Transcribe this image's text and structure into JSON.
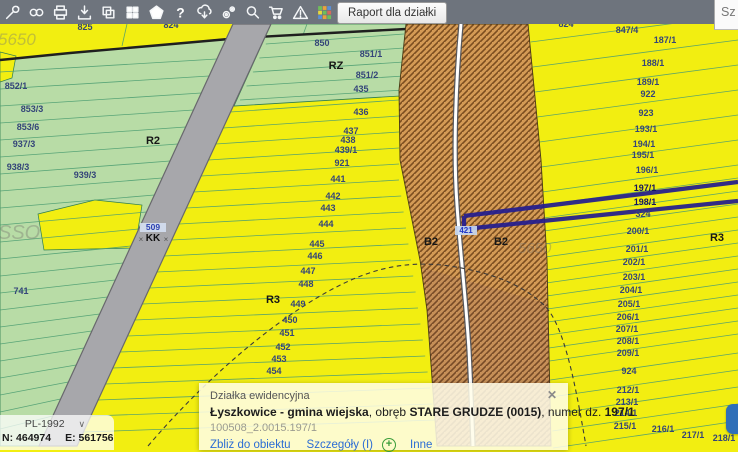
{
  "toolbar": {
    "background": "#6e747d",
    "icons": [
      {
        "name": "tools-icon"
      },
      {
        "name": "link-icon"
      },
      {
        "name": "print-icon"
      },
      {
        "name": "download-icon"
      },
      {
        "name": "copy-icon"
      },
      {
        "name": "tiles-icon"
      },
      {
        "name": "polygon-icon"
      },
      {
        "name": "help-icon"
      },
      {
        "name": "cloud-download-icon"
      },
      {
        "name": "settings-icon"
      },
      {
        "name": "search-icon"
      },
      {
        "name": "cart-icon"
      },
      {
        "name": "warning-icon"
      },
      {
        "name": "palette-icon"
      }
    ],
    "report_button_label": "Raport dla działki",
    "side_panel_label": "Sz"
  },
  "map": {
    "colors": {
      "parcel_yellow": "#f2ee11",
      "parcel_green": "#b8dca6",
      "railway_gray": "#a7a7ab",
      "hatch_orange": "#d49a55",
      "hatch_line": "#7c4e20",
      "selection_blue": "#241d8e",
      "boundary_green": "#4d9e72",
      "label_navy": "#344579"
    },
    "labels": [
      {
        "t": "825",
        "x": 85,
        "y": 30,
        "c": "p"
      },
      {
        "t": "824",
        "x": 171,
        "y": 28,
        "c": "p"
      },
      {
        "t": "824",
        "x": 566,
        "y": 27,
        "c": "p"
      },
      {
        "t": "850",
        "x": 322,
        "y": 46,
        "c": "p"
      },
      {
        "t": "851/1",
        "x": 371,
        "y": 57,
        "c": "p"
      },
      {
        "t": "RZ",
        "x": 336,
        "y": 69,
        "c": "k"
      },
      {
        "t": "851/2",
        "x": 367,
        "y": 78,
        "c": "p"
      },
      {
        "t": "435",
        "x": 361,
        "y": 92,
        "c": "p"
      },
      {
        "t": "436",
        "x": 361,
        "y": 115,
        "c": "p"
      },
      {
        "t": "437",
        "x": 351,
        "y": 134,
        "c": "p"
      },
      {
        "t": "438",
        "x": 348,
        "y": 143,
        "c": "p"
      },
      {
        "t": "439/1",
        "x": 346,
        "y": 153,
        "c": "p"
      },
      {
        "t": "921",
        "x": 342,
        "y": 166,
        "c": "p"
      },
      {
        "t": "441",
        "x": 338,
        "y": 182,
        "c": "p"
      },
      {
        "t": "442",
        "x": 333,
        "y": 199,
        "c": "p"
      },
      {
        "t": "443",
        "x": 328,
        "y": 211,
        "c": "p"
      },
      {
        "t": "444",
        "x": 326,
        "y": 227,
        "c": "p"
      },
      {
        "t": "445",
        "x": 317,
        "y": 247,
        "c": "p"
      },
      {
        "t": "446",
        "x": 315,
        "y": 259,
        "c": "p"
      },
      {
        "t": "447",
        "x": 308,
        "y": 274,
        "c": "p"
      },
      {
        "t": "448",
        "x": 306,
        "y": 287,
        "c": "p"
      },
      {
        "t": "R3",
        "x": 273,
        "y": 303,
        "c": "k"
      },
      {
        "t": "449",
        "x": 298,
        "y": 307,
        "c": "p"
      },
      {
        "t": "450",
        "x": 290,
        "y": 323,
        "c": "p"
      },
      {
        "t": "451",
        "x": 287,
        "y": 336,
        "c": "p"
      },
      {
        "t": "452",
        "x": 283,
        "y": 350,
        "c": "p"
      },
      {
        "t": "453",
        "x": 279,
        "y": 362,
        "c": "p"
      },
      {
        "t": "454",
        "x": 274,
        "y": 374,
        "c": "p"
      },
      {
        "t": "852/1",
        "x": 16,
        "y": 89,
        "c": "p"
      },
      {
        "t": "853/3",
        "x": 32,
        "y": 112,
        "c": "p"
      },
      {
        "t": "853/6",
        "x": 28,
        "y": 130,
        "c": "p"
      },
      {
        "t": "937/3",
        "x": 24,
        "y": 147,
        "c": "p"
      },
      {
        "t": "938/3",
        "x": 18,
        "y": 170,
        "c": "p"
      },
      {
        "t": "939/3",
        "x": 85,
        "y": 178,
        "c": "p"
      },
      {
        "t": "R2",
        "x": 153,
        "y": 144,
        "c": "k"
      },
      {
        "t": "741",
        "x": 21,
        "y": 294,
        "c": "p"
      },
      {
        "t": "B2",
        "x": 431,
        "y": 245,
        "c": "k"
      },
      {
        "t": "B2",
        "x": 501,
        "y": 245,
        "c": "k"
      },
      {
        "t": "421",
        "x": 466,
        "y": 233,
        "c": "hl"
      },
      {
        "t": "509",
        "x": 153,
        "y": 230,
        "c": "r1"
      },
      {
        "t": "KK",
        "x": 153,
        "y": 241,
        "c": "r2"
      },
      {
        "t": "×",
        "x": 141,
        "y": 242,
        "c": "x"
      },
      {
        "t": "×",
        "x": 166,
        "y": 242,
        "c": "x"
      },
      {
        "t": "847/4",
        "x": 627,
        "y": 33,
        "c": "p"
      },
      {
        "t": "187/1",
        "x": 665,
        "y": 43,
        "c": "p"
      },
      {
        "t": "188/1",
        "x": 653,
        "y": 66,
        "c": "p"
      },
      {
        "t": "189/1",
        "x": 648,
        "y": 85,
        "c": "p"
      },
      {
        "t": "922",
        "x": 648,
        "y": 97,
        "c": "p"
      },
      {
        "t": "923",
        "x": 646,
        "y": 116,
        "c": "p"
      },
      {
        "t": "193/1",
        "x": 646,
        "y": 132,
        "c": "p"
      },
      {
        "t": "194/1",
        "x": 644,
        "y": 147,
        "c": "p"
      },
      {
        "t": "195/1",
        "x": 643,
        "y": 158,
        "c": "p"
      },
      {
        "t": "196/1",
        "x": 647,
        "y": 173,
        "c": "p"
      },
      {
        "t": "197/1",
        "x": 645,
        "y": 191,
        "c": "b"
      },
      {
        "t": "198/1",
        "x": 645,
        "y": 205,
        "c": "b"
      },
      {
        "t": "324",
        "x": 643,
        "y": 217,
        "c": "p"
      },
      {
        "t": "200/1",
        "x": 638,
        "y": 234,
        "c": "p"
      },
      {
        "t": "R3",
        "x": 717,
        "y": 241,
        "c": "k"
      },
      {
        "t": "201/1",
        "x": 637,
        "y": 252,
        "c": "p"
      },
      {
        "t": "202/1",
        "x": 634,
        "y": 265,
        "c": "p"
      },
      {
        "t": "203/1",
        "x": 634,
        "y": 280,
        "c": "p"
      },
      {
        "t": "204/1",
        "x": 631,
        "y": 293,
        "c": "p"
      },
      {
        "t": "205/1",
        "x": 629,
        "y": 307,
        "c": "p"
      },
      {
        "t": "206/1",
        "x": 628,
        "y": 320,
        "c": "p"
      },
      {
        "t": "207/1",
        "x": 627,
        "y": 332,
        "c": "p"
      },
      {
        "t": "208/1",
        "x": 628,
        "y": 344,
        "c": "p"
      },
      {
        "t": "209/1",
        "x": 628,
        "y": 356,
        "c": "p"
      },
      {
        "t": "924",
        "x": 629,
        "y": 374,
        "c": "p"
      },
      {
        "t": "212/1",
        "x": 628,
        "y": 393,
        "c": "p"
      },
      {
        "t": "213/1",
        "x": 627,
        "y": 405,
        "c": "p"
      },
      {
        "t": "214/1",
        "x": 626,
        "y": 416,
        "c": "p"
      },
      {
        "t": "215/1",
        "x": 625,
        "y": 429,
        "c": "p"
      },
      {
        "t": "216/1",
        "x": 663,
        "y": 432,
        "c": "p"
      },
      {
        "t": "217/1",
        "x": 693,
        "y": 438,
        "c": "p"
      },
      {
        "t": "218/1",
        "x": 724,
        "y": 441,
        "c": "p"
      },
      {
        "t": "5650",
        "x": -2,
        "y": 45,
        "c": "w",
        "s": 17
      },
      {
        "t": "SSO",
        "x": -2,
        "y": 239,
        "c": "w",
        "s": 20
      },
      {
        "t": "5650",
        "x": 518,
        "y": 253,
        "c": "w",
        "s": 15
      }
    ]
  },
  "popup": {
    "title": "Działka ewidencyjna",
    "close_glyph": "✕",
    "line_parts": [
      {
        "t": "Łyszkowice - gmina wiejska",
        "b": 1
      },
      {
        "t": ", obręb ",
        "b": 0
      },
      {
        "t": "STARE GRUDZE (0015)",
        "b": 1
      },
      {
        "t": ", numer dz. ",
        "b": 0
      },
      {
        "t": "197/1",
        "b": 1
      }
    ],
    "id_line": "100508_2.0015.197/1",
    "links": [
      "Zbliż do obiektu",
      "Szczegóły (I)",
      "Inne"
    ],
    "plus_glyph": "+"
  },
  "coords_panel": {
    "crs": "PL-1992",
    "chevron_glyph": "∨",
    "n_label": "N:",
    "n_value": "464974",
    "e_label": "E:",
    "e_value": "561756"
  }
}
